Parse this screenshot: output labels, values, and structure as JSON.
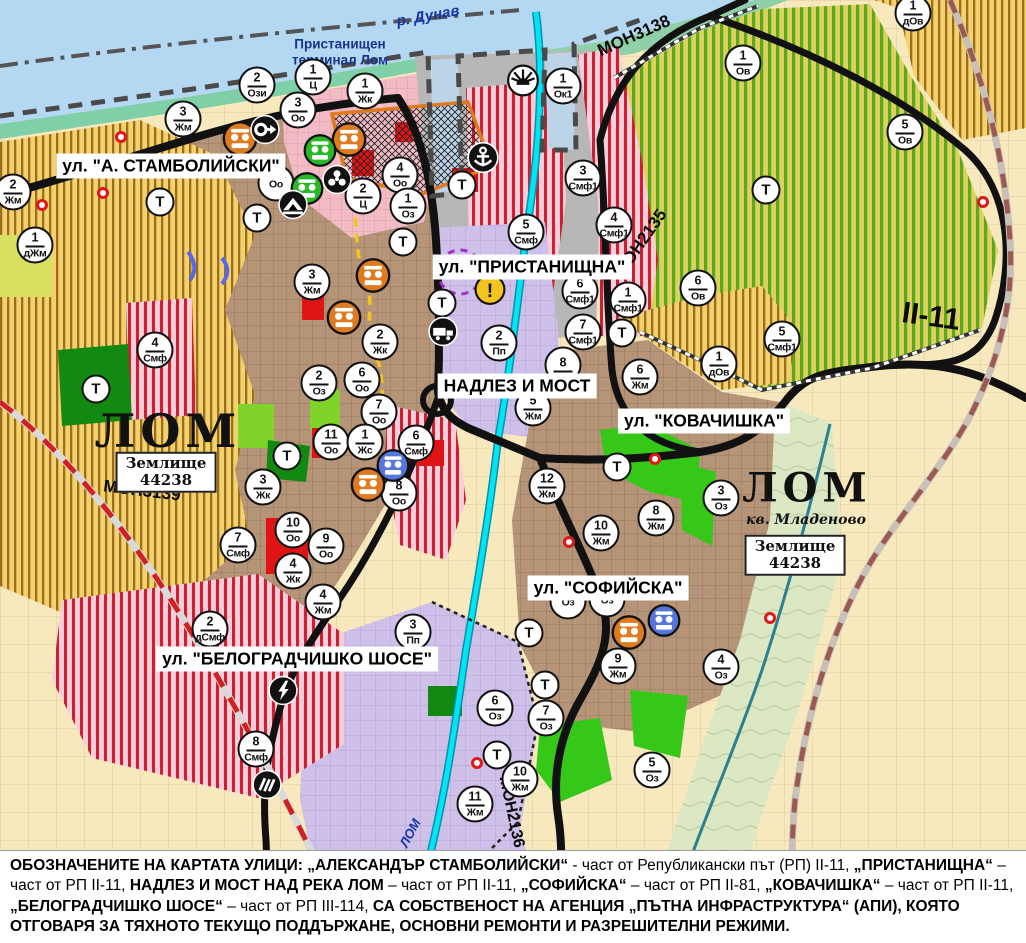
{
  "map": {
    "colors": {
      "water": "#b5d8f2",
      "urban_brown": "#b69478",
      "villa_yellow": "#f3d26e",
      "smf_pink": "#f6cdd9",
      "smf_stripe": "#cc2030",
      "orchard_green": "#d9d25f",
      "orchard_stripe": "#5fa81e",
      "production_purple": "#cfc0ea",
      "farmland_cream": "#f7e9bd",
      "port_gray": "#b7b7b7",
      "center_pink": "#f3bcc4",
      "green_area": "#35c818",
      "road_black": "#111111",
      "river_cyan": "#00e4f4",
      "rail_red": "#d22020"
    },
    "street_labels": [
      {
        "text": "ул. \"А. СТАМБОЛИЙСКИ\"",
        "x": 171,
        "y": 166
      },
      {
        "text": "ул. \"ПРИСТАНИЩНА\"",
        "x": 532,
        "y": 267
      },
      {
        "text": "НАДЛЕЗ И МОСТ",
        "x": 517,
        "y": 386
      },
      {
        "text": "ул. \"КОВАЧИШКА\"",
        "x": 704,
        "y": 421
      },
      {
        "text": "ул. \"СОФИЙСКА\"",
        "x": 608,
        "y": 588
      },
      {
        "text": "ул. \"БЕЛОГРАДЧИШКО ШОСЕ\"",
        "x": 297,
        "y": 659
      }
    ],
    "road_labels": [
      {
        "text": "MOH3138",
        "x": 634,
        "y": 36,
        "rot": -24,
        "size": 17
      },
      {
        "text": "MOH2135",
        "x": 641,
        "y": 243,
        "rot": -55,
        "size": 17
      },
      {
        "text": "II-11",
        "x": 931,
        "y": 317,
        "rot": 8,
        "size": 30
      },
      {
        "text": "MOH3139",
        "x": 142,
        "y": 491,
        "rot": 7,
        "size": 17
      },
      {
        "text": "MOH2136",
        "x": 511,
        "y": 812,
        "rot": 78,
        "size": 16
      }
    ],
    "area_labels": [
      {
        "text": "ЛОМ",
        "x": 168,
        "y": 431,
        "size": 46
      },
      {
        "text": "ЛОМ",
        "x": 807,
        "y": 488,
        "size": 40
      }
    ],
    "sub_labels": [
      {
        "text": "кв. Младеново",
        "x": 806,
        "y": 520
      }
    ],
    "land_boxes": [
      {
        "text": "Землище\n44238",
        "x": 166,
        "y": 472
      },
      {
        "text": "Землище\n44238",
        "x": 795,
        "y": 555
      }
    ],
    "water_labels": [
      {
        "text": "р. Дунав",
        "x": 428,
        "y": 16,
        "rot": -10,
        "size": 15
      },
      {
        "text": "ЛОМ",
        "x": 410,
        "y": 833,
        "rot": -62,
        "size": 13
      }
    ],
    "poi_labels": [
      {
        "text": "Пристанищен\nтерминал Лом",
        "x": 340,
        "y": 52
      }
    ],
    "t_label": "Т",
    "t_markers": [
      {
        "x": 462,
        "y": 185
      },
      {
        "x": 160,
        "y": 202
      },
      {
        "x": 257,
        "y": 218
      },
      {
        "x": 403,
        "y": 242
      },
      {
        "x": 442,
        "y": 303
      },
      {
        "x": 622,
        "y": 333
      },
      {
        "x": 766,
        "y": 190
      },
      {
        "x": 96,
        "y": 389
      },
      {
        "x": 287,
        "y": 456
      },
      {
        "x": 617,
        "y": 467
      },
      {
        "x": 529,
        "y": 633
      },
      {
        "x": 545,
        "y": 685
      },
      {
        "x": 497,
        "y": 755
      }
    ],
    "markers": [
      {
        "x": 257,
        "y": 85,
        "n": "2",
        "c": "Ози"
      },
      {
        "x": 313,
        "y": 77,
        "n": "1",
        "c": "Ц"
      },
      {
        "x": 298,
        "y": 110,
        "n": "3",
        "c": "Оо"
      },
      {
        "x": 365,
        "y": 91,
        "n": "1",
        "c": "Жк"
      },
      {
        "x": 183,
        "y": 119,
        "n": "3",
        "c": "Жм"
      },
      {
        "x": 13,
        "y": 192,
        "n": "2",
        "c": "Жм"
      },
      {
        "x": 35,
        "y": 245,
        "n": "1",
        "c": "дЖм"
      },
      {
        "x": 312,
        "y": 282,
        "n": "3",
        "c": "Жм"
      },
      {
        "x": 400,
        "y": 175,
        "n": "4",
        "c": "Оо"
      },
      {
        "x": 276,
        "y": 183,
        "n": "",
        "c": "Оо"
      },
      {
        "x": 363,
        "y": 196,
        "n": "2",
        "c": "Ц"
      },
      {
        "x": 408,
        "y": 206,
        "n": "1",
        "c": "Оз"
      },
      {
        "x": 563,
        "y": 86,
        "n": "1",
        "c": "Ок1"
      },
      {
        "x": 526,
        "y": 232,
        "n": "5",
        "c": "Смф"
      },
      {
        "x": 583,
        "y": 178,
        "n": "3",
        "c": "Смф1"
      },
      {
        "x": 614,
        "y": 225,
        "n": "4",
        "c": "Смф1"
      },
      {
        "x": 580,
        "y": 291,
        "n": "6",
        "c": "Смф1"
      },
      {
        "x": 628,
        "y": 300,
        "n": "1",
        "c": "Смф1"
      },
      {
        "x": 583,
        "y": 332,
        "n": "7",
        "c": "Смф1"
      },
      {
        "x": 743,
        "y": 63,
        "n": "1",
        "c": "Ов"
      },
      {
        "x": 905,
        "y": 132,
        "n": "5",
        "c": "Ов"
      },
      {
        "x": 913,
        "y": 13,
        "n": "1",
        "c": "дОв"
      },
      {
        "x": 698,
        "y": 288,
        "n": "6",
        "c": "Ов"
      },
      {
        "x": 719,
        "y": 364,
        "n": "1",
        "c": "дОв"
      },
      {
        "x": 782,
        "y": 339,
        "n": "5",
        "c": "Смф1"
      },
      {
        "x": 640,
        "y": 377,
        "n": "6",
        "c": "Жм"
      },
      {
        "x": 499,
        "y": 343,
        "n": "2",
        "c": "Пп"
      },
      {
        "x": 533,
        "y": 408,
        "n": "5",
        "c": "Жм"
      },
      {
        "x": 563,
        "y": 365,
        "n": "8",
        "c": ""
      },
      {
        "x": 416,
        "y": 443,
        "n": "6",
        "c": "Смф"
      },
      {
        "x": 380,
        "y": 342,
        "n": "2",
        "c": "Жк"
      },
      {
        "x": 362,
        "y": 380,
        "n": "6",
        "c": "Оо"
      },
      {
        "x": 379,
        "y": 412,
        "n": "7",
        "c": "Оо"
      },
      {
        "x": 319,
        "y": 383,
        "n": "2",
        "c": "Оз"
      },
      {
        "x": 331,
        "y": 442,
        "n": "11",
        "c": "Оо"
      },
      {
        "x": 365,
        "y": 442,
        "n": "1",
        "c": "Жс"
      },
      {
        "x": 155,
        "y": 350,
        "n": "4",
        "c": "Смф"
      },
      {
        "x": 263,
        "y": 487,
        "n": "3",
        "c": "Жк"
      },
      {
        "x": 293,
        "y": 530,
        "n": "10",
        "c": "Оо"
      },
      {
        "x": 326,
        "y": 546,
        "n": "9",
        "c": "Оо"
      },
      {
        "x": 293,
        "y": 571,
        "n": "4",
        "c": "Жк"
      },
      {
        "x": 323,
        "y": 602,
        "n": "4",
        "c": "Жм"
      },
      {
        "x": 238,
        "y": 545,
        "n": "7",
        "c": "Смф"
      },
      {
        "x": 399,
        "y": 493,
        "n": "8",
        "c": "Оо"
      },
      {
        "x": 210,
        "y": 629,
        "n": "2",
        "c": "дСмф"
      },
      {
        "x": 413,
        "y": 632,
        "n": "3",
        "c": "Пп"
      },
      {
        "x": 256,
        "y": 749,
        "n": "8",
        "c": "Смф"
      },
      {
        "x": 547,
        "y": 486,
        "n": "12",
        "c": "Жм"
      },
      {
        "x": 601,
        "y": 533,
        "n": "10",
        "c": "Жм"
      },
      {
        "x": 656,
        "y": 518,
        "n": "8",
        "c": "Жм"
      },
      {
        "x": 721,
        "y": 498,
        "n": "3",
        "c": "Оз"
      },
      {
        "x": 568,
        "y": 601,
        "n": "",
        "c": "Оз"
      },
      {
        "x": 607,
        "y": 599,
        "n": "",
        "c": "Оз"
      },
      {
        "x": 618,
        "y": 666,
        "n": "9",
        "c": "Жм"
      },
      {
        "x": 721,
        "y": 667,
        "n": "4",
        "c": "Оз"
      },
      {
        "x": 495,
        "y": 708,
        "n": "6",
        "c": "Оз"
      },
      {
        "x": 546,
        "y": 718,
        "n": "7",
        "c": "Оз"
      },
      {
        "x": 652,
        "y": 770,
        "n": "5",
        "c": "Оз"
      },
      {
        "x": 520,
        "y": 779,
        "n": "10",
        "c": "Жм"
      },
      {
        "x": 475,
        "y": 804,
        "n": "11",
        "c": "Жм"
      }
    ],
    "special_icons": [
      {
        "t": "monument",
        "col": "#e07a1e",
        "x": 240,
        "y": 141,
        "s": 36
      },
      {
        "t": "monument",
        "col": "#e07a1e",
        "x": 349,
        "y": 142,
        "s": 36
      },
      {
        "t": "monument",
        "col": "#e07a1e",
        "x": 373,
        "y": 278,
        "s": 36
      },
      {
        "t": "monument",
        "col": "#e07a1e",
        "x": 344,
        "y": 320,
        "s": 36
      },
      {
        "t": "monument",
        "col": "#e07a1e",
        "x": 368,
        "y": 487,
        "s": 36
      },
      {
        "t": "monument",
        "col": "#e07a1e",
        "x": 629,
        "y": 635,
        "s": 36
      },
      {
        "t": "monument",
        "col": "#28b828",
        "x": 320,
        "y": 153,
        "s": 34
      },
      {
        "t": "monument",
        "col": "#28b828",
        "x": 307,
        "y": 191,
        "s": 34
      },
      {
        "t": "monument",
        "col": "#5577dd",
        "x": 393,
        "y": 468,
        "s": 34
      },
      {
        "t": "monument",
        "col": "#5577dd",
        "x": 664,
        "y": 623,
        "s": 34
      },
      {
        "t": "circle-arrow",
        "col": "#111111",
        "x": 265,
        "y": 132,
        "s": 31
      },
      {
        "t": "trefoil",
        "col": "#111111",
        "x": 337,
        "y": 182,
        "s": 31
      },
      {
        "t": "cave",
        "col": "#111111",
        "x": 293,
        "y": 207,
        "s": 31
      },
      {
        "t": "anchor",
        "col": "#111111",
        "x": 483,
        "y": 160,
        "s": 33
      },
      {
        "t": "sun",
        "col": "#ffffff",
        "x": 523,
        "y": 83,
        "s": 33
      },
      {
        "t": "truck",
        "col": "#111111",
        "x": 443,
        "y": 334,
        "s": 31
      },
      {
        "t": "warning",
        "col": "#f2c41c",
        "x": 490,
        "y": 292,
        "s": 32
      },
      {
        "t": "lightning",
        "col": "#111111",
        "x": 283,
        "y": 693,
        "s": 31
      },
      {
        "t": "rail-station",
        "col": "#111111",
        "x": 267,
        "y": 787,
        "s": 31
      }
    ],
    "red_dots": [
      {
        "x": 121,
        "y": 137
      },
      {
        "x": 103,
        "y": 193
      },
      {
        "x": 42,
        "y": 205
      },
      {
        "x": 983,
        "y": 202
      },
      {
        "x": 655,
        "y": 459
      },
      {
        "x": 569,
        "y": 542
      },
      {
        "x": 770,
        "y": 618
      },
      {
        "x": 477,
        "y": 763
      }
    ]
  },
  "banner": {
    "segments": [
      {
        "text": "ОБОЗНАЧЕНИТЕ НА КАРТАТА УЛИЦИ: „АЛЕКСАНДЪР СТАМБОЛИЙСКИ“",
        "bold": true
      },
      {
        "text": " - част от Републикански път (РП) II-11, ",
        "bold": false
      },
      {
        "text": "„ПРИСТАНИЩНА“",
        "bold": true
      },
      {
        "text": " – част от РП II-11, ",
        "bold": false
      },
      {
        "text": "НАДЛЕЗ И МОСТ НАД РЕКА ЛОМ",
        "bold": true
      },
      {
        "text": " – част от РП II-11, ",
        "bold": false
      },
      {
        "text": "„СОФИЙСКА“",
        "bold": true
      },
      {
        "text": " – част от РП II-81, ",
        "bold": false
      },
      {
        "text": "„КОВАЧИШКА“",
        "bold": true
      },
      {
        "text": " – част от РП II-11, ",
        "bold": false
      },
      {
        "text": "„БЕЛОГРАДЧИШКО ШОСЕ“",
        "bold": true
      },
      {
        "text": " – част от РП III-114, ",
        "bold": false
      },
      {
        "text": "СА СОБСТВЕНОСТ НА АГЕНЦИЯ „ПЪТНА ИНФРАСТРУКТУРА“ (АПИ), КОЯТО ОТГОВАРЯ ЗА ТЯХНОТО ТЕКУЩО ПОДДЪРЖАНЕ, ОСНОВНИ РЕМОНТИ И РАЗРЕШИТЕЛНИ РЕЖИМИ.",
        "bold": true
      }
    ]
  }
}
